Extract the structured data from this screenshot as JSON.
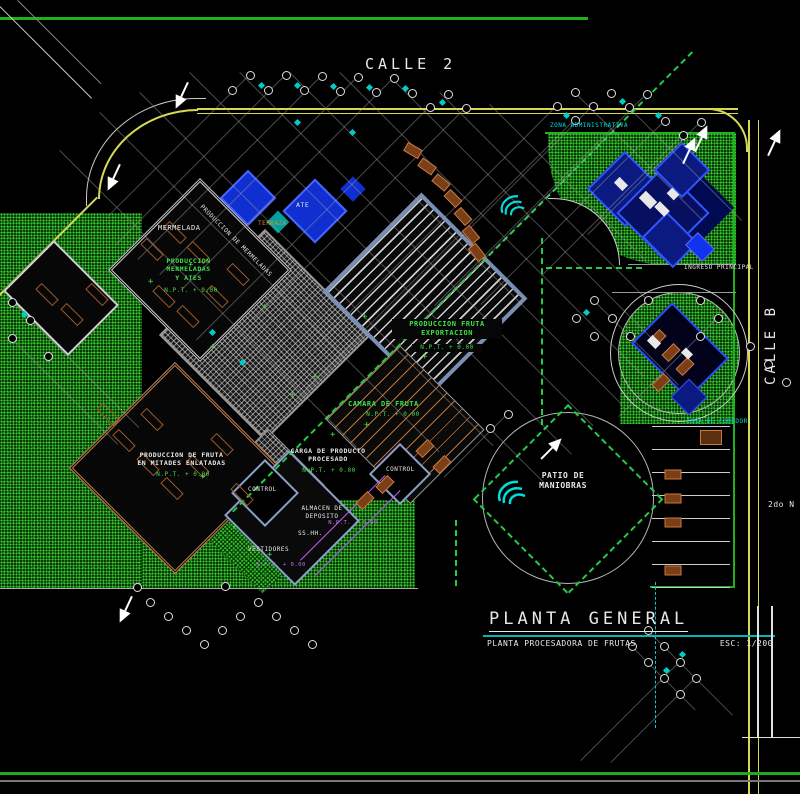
{
  "drawing": {
    "streets": {
      "calle2": "CALLE 2",
      "calle_b": "CALLE B"
    },
    "zones": {
      "administrativa": "ZONA ADMINISTRATIVA",
      "ingreso_principal": "INGRESO PRINCIPAL",
      "comedor": "ZONA DE COMEDOR",
      "patio_maniobras": "PATIO DE\nMANIOBRAS",
      "nivel": "2do N",
      "produccion_mermeladas": "PRODUCCION DE MERMELADAS"
    },
    "rooms": {
      "mermelada": "MERMELADA",
      "produccion_mermeladas_ates": "PRODUCCION\nMERMELADAS\nY ATES",
      "ate": "ATE",
      "terraza": "TERRAZA",
      "produccion_fruta_exportacion": "PRODUCCION FRUTA\nEXPORTACION",
      "camara_fruta": "CAMARA DE FRUTA",
      "carga_producto": "CARGA DE PRODUCTO\nPROCESADO",
      "preparacion_fruta": "PRODUCCION DE FRUTA\nEN MITADES ENLATADAS",
      "control_a": "CONTROL",
      "control_b": "CONTROL",
      "almacen": "ALMACEN DE\nDEPOSITO",
      "sshh": "SS.HH.",
      "vestidores": "VESTIDORES"
    },
    "elevation": {
      "npt": "N.P.T. + 0.00"
    },
    "title_block": {
      "title": "PLANTA GENERAL",
      "subtitle": "PLANTA PROCESADORA DE FRUTAS",
      "scale": "ESC: 1/200"
    },
    "colors": {
      "background": "#000000",
      "grass": "#33cc33",
      "curb": "#d8d855",
      "building_blue": "#1a35e0",
      "steel_blue": "#7a8fb5",
      "car_brown": "#8a4a1f",
      "dashed_green": "#22cc44",
      "cyan": "#00dcdc",
      "axis_gray": "#9a9a9a"
    }
  }
}
